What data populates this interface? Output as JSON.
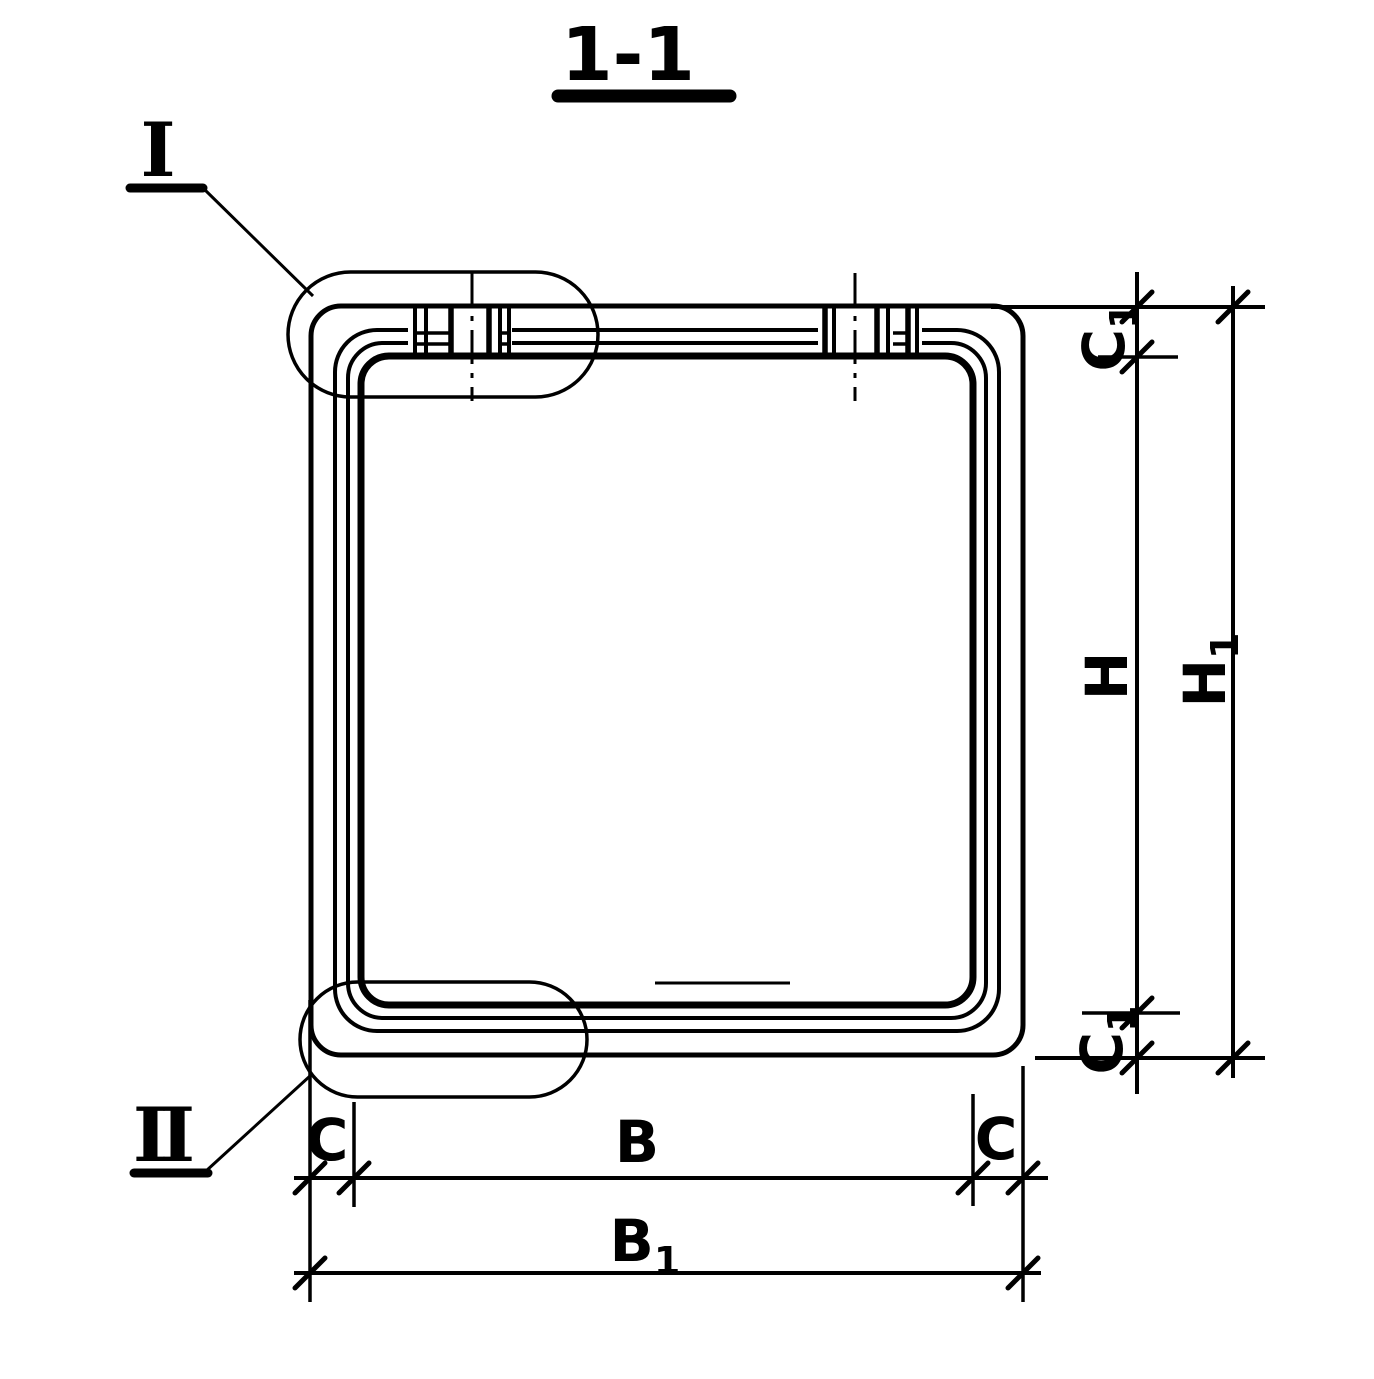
{
  "drawing": {
    "title": "1-1",
    "details": {
      "detail_1": "I",
      "detail_2": "II"
    },
    "dimensions": {
      "c1_top": {
        "base": "C",
        "sub": "1"
      },
      "h": {
        "base": "H",
        "sub": ""
      },
      "h1": {
        "base": "H",
        "sub": "1"
      },
      "c1_bottom": {
        "base": "C",
        "sub": "1"
      },
      "c_left": {
        "base": "C",
        "sub": ""
      },
      "b": {
        "base": "B",
        "sub": ""
      },
      "c_right": {
        "base": "C",
        "sub": ""
      },
      "b1": {
        "base": "B",
        "sub": "1"
      }
    },
    "colors": {
      "ink": "#000000",
      "paper": "#ffffff"
    }
  }
}
